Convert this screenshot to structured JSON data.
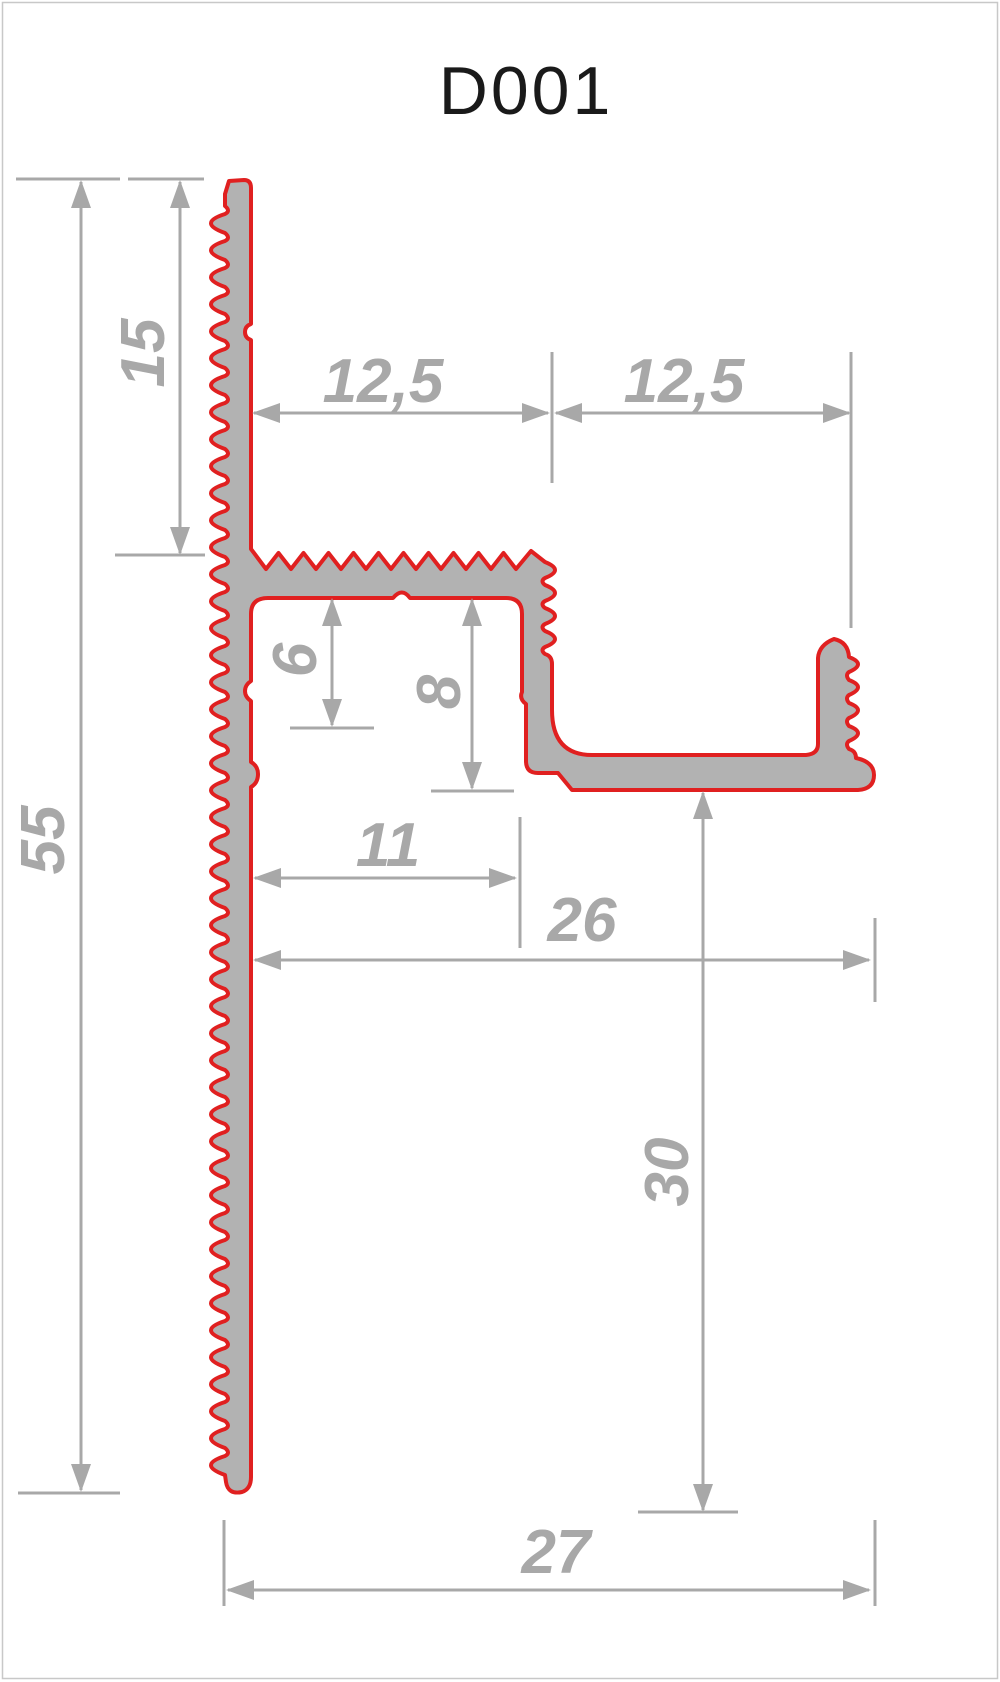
{
  "title": "D001",
  "colors": {
    "profile_outline": "#e02020",
    "profile_fill": "#b2b2b2",
    "dimension_gray": "#a8a8a8",
    "title_text": "#1a1a1a",
    "frame_border": "#c8c8c8"
  },
  "dimensions": {
    "height_total": {
      "label": "55"
    },
    "height_top": {
      "label": "15"
    },
    "width_left_half": {
      "label": "12,5"
    },
    "width_right_half": {
      "label": "12,5"
    },
    "depth_small": {
      "label": "6"
    },
    "depth_large": {
      "label": "8"
    },
    "width_inner": {
      "label": "11"
    },
    "width_base": {
      "label": "26"
    },
    "height_lower": {
      "label": "30"
    },
    "width_total": {
      "label": "27"
    }
  }
}
